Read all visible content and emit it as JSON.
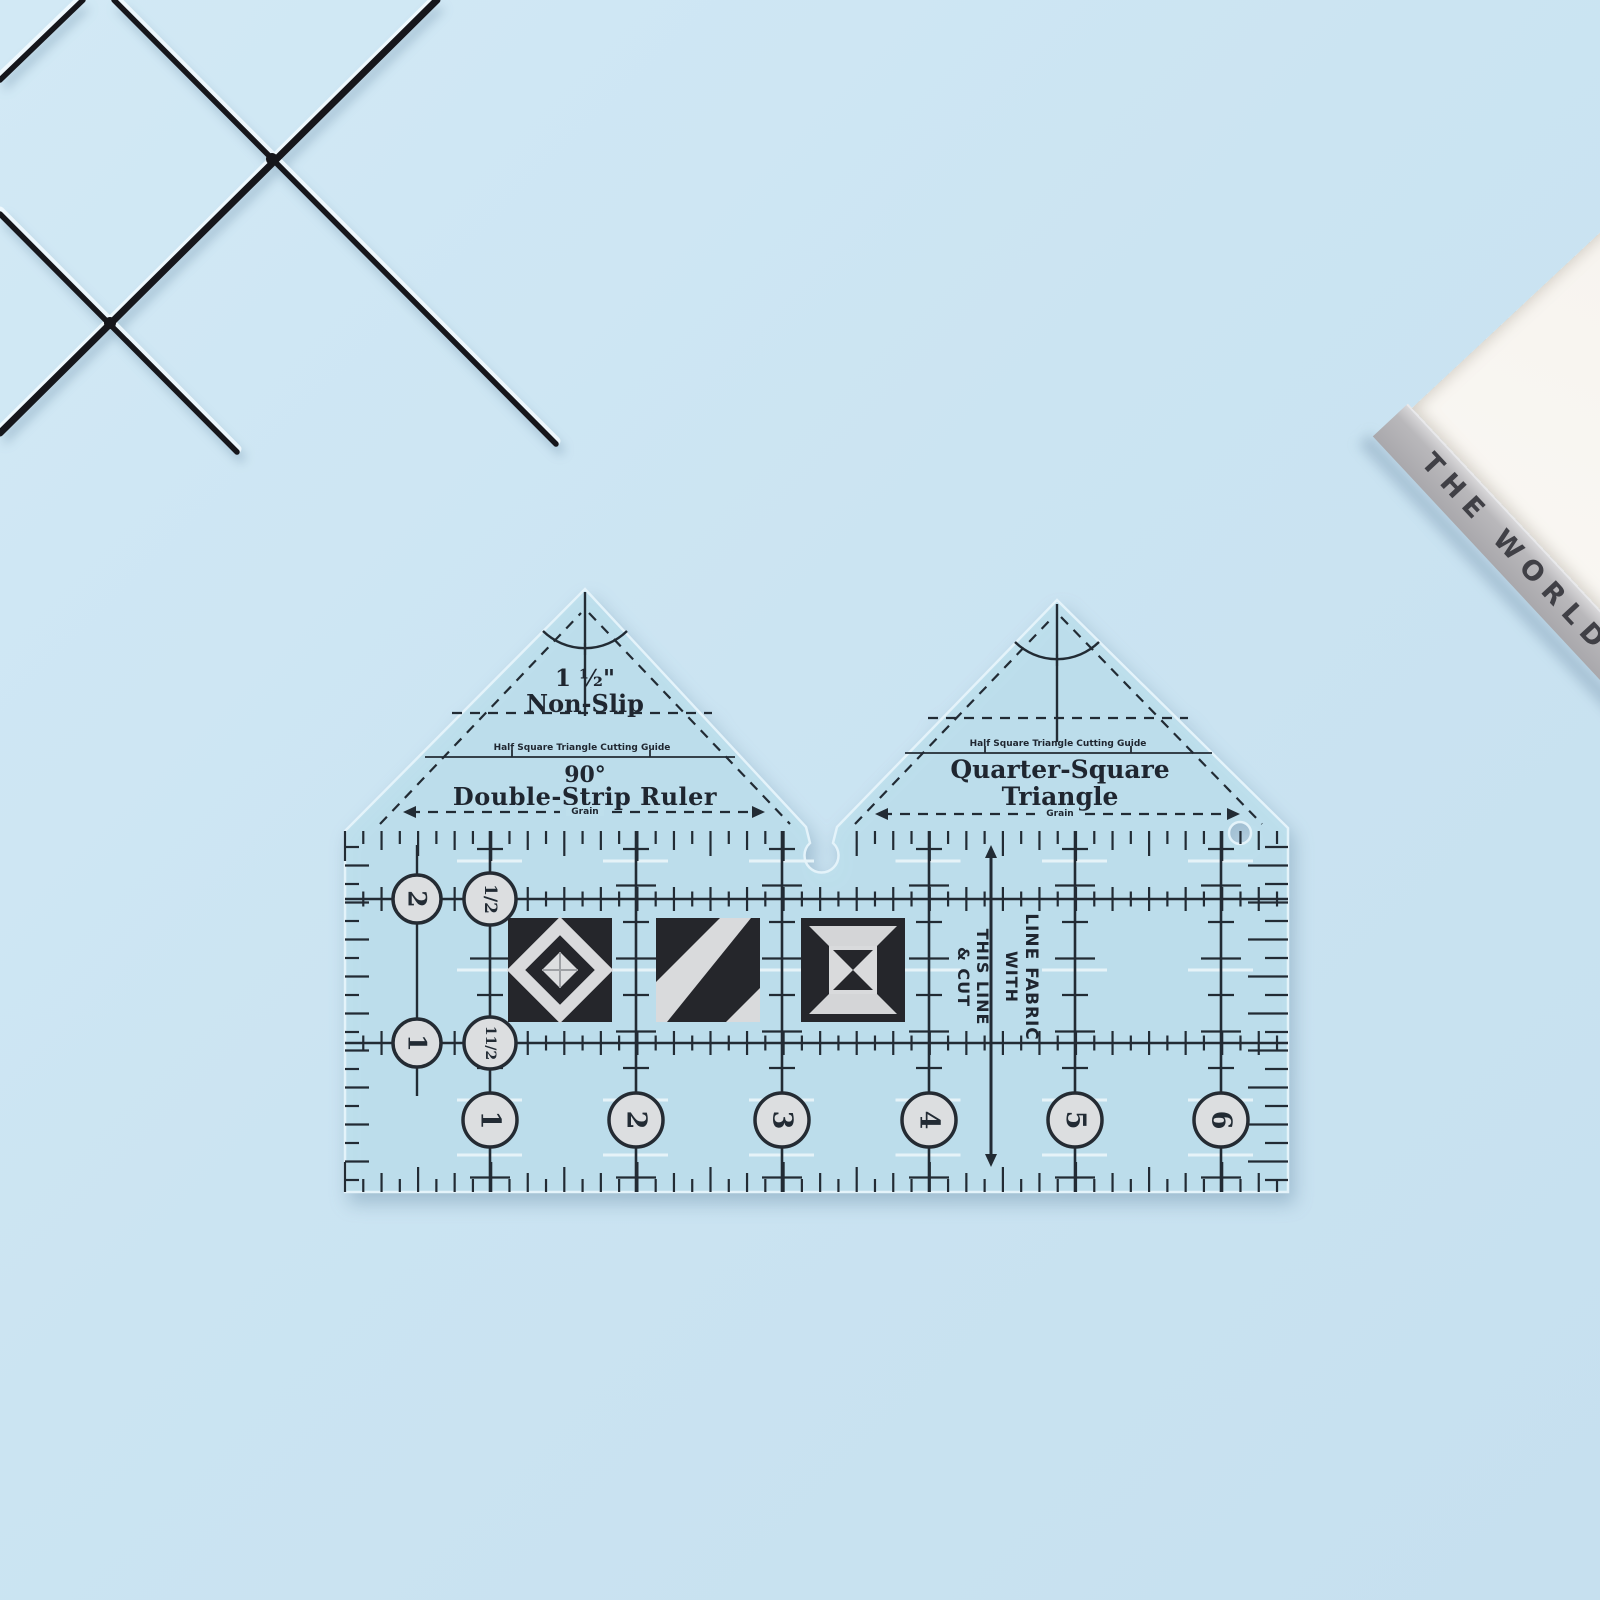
{
  "scene": {
    "background_color": "#cbe4f2"
  },
  "wire_rack": {
    "color": "#17171c"
  },
  "book": {
    "spine_text": "THE WORLD",
    "cover_color": "#f6f3ee",
    "spine_color": "#b5b4b6"
  },
  "ruler": {
    "fill_color": "#bedfec",
    "ink_color": "#222b34",
    "left_triangle": {
      "size": "1 ½\"",
      "grip": "Non-Slip",
      "cutting_guide": "Half Square Triangle Cutting Guide",
      "angle": "90°",
      "title": "Double-Strip Ruler",
      "grain": "Grain"
    },
    "right_triangle": {
      "cutting_guide": "Half Square Triangle Cutting Guide",
      "title_line1": "Quarter-Square",
      "title_line2": "Triangle",
      "grain": "Grain"
    },
    "body": {
      "row1_circles": [
        "2",
        "1/2"
      ],
      "row2_circles": [
        "1",
        "11/2"
      ],
      "bottom_circles": [
        "1",
        "2",
        "3",
        "4",
        "5",
        "6"
      ],
      "instruction_lines": [
        "LINE FABRIC",
        "WITH",
        "THIS LINE",
        "& CUT"
      ]
    }
  }
}
